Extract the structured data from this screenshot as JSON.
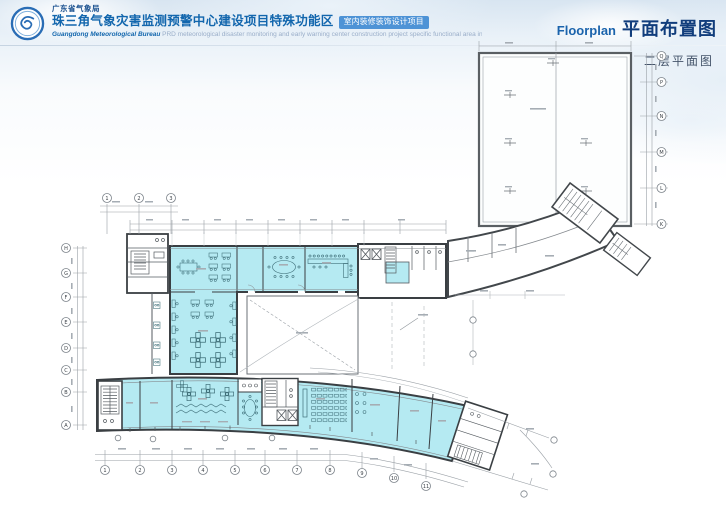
{
  "header": {
    "org_name": "广东省气象局",
    "project_title": "珠三角气象灾害监测预警中心建设项目特殊功能区",
    "project_badge": "室内装修装饰设计项目",
    "org_name_en": "Guangdong Meteorological Bureau",
    "project_desc_en": "PRD meteorological disaster monitoring and early warning center construction project specific functional area interior decoration design projects",
    "page_title_en": "Floorplan",
    "page_title_zh": "平面布置图"
  },
  "drawing": {
    "subtitle": "二层平面图",
    "colors": {
      "room_fill": "#b5eaf2",
      "wall": "#3a3f43",
      "dimension_line": "#9aa0a6",
      "title_blue": "#1266ad",
      "title_navy": "#113d7c"
    },
    "grid": {
      "bottom_labels": [
        "1",
        "2",
        "3",
        "4",
        "5",
        "6",
        "7",
        "8"
      ],
      "arc_labels": [
        "9",
        "10",
        "11"
      ],
      "left_labels": [
        "H",
        "G",
        "F",
        "E",
        "D",
        "C",
        "B",
        "A"
      ],
      "right_labels": [
        "Q",
        "P",
        "N",
        "M",
        "L",
        "K"
      ]
    }
  }
}
